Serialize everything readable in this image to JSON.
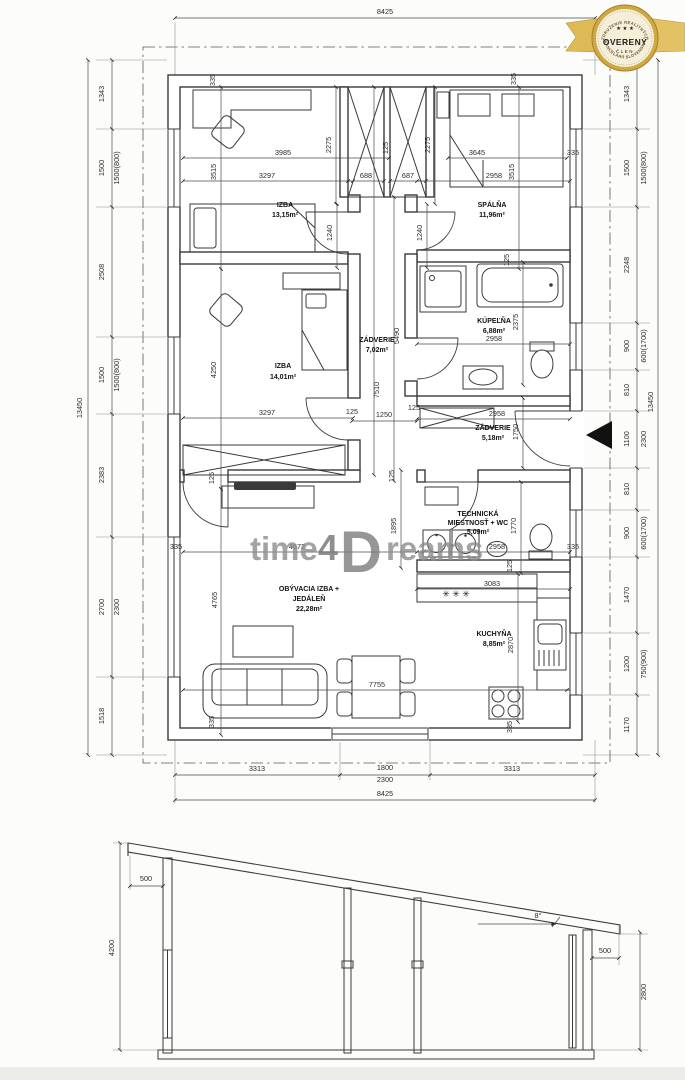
{
  "badge": {
    "arc_top": "ZDRUŽENIE REALITNÝCH",
    "arc_bottom": "KANCELÁRIÍ SLOVENSKA",
    "stars": "★ ★ ★",
    "title": "OVERENÝ",
    "subtitle": "ČLEN",
    "gold": "#cfa93f"
  },
  "watermark": {
    "t1": "time",
    "t2": "4",
    "t3": "D",
    "t4": "reams"
  },
  "rooms": {
    "izba1": {
      "name": "IZBA",
      "area": "13,15m²"
    },
    "spalna": {
      "name": "SPÁLŇA",
      "area": "11,96m²"
    },
    "zadverie1": {
      "name": "ZÁDVERIE",
      "area": "7,02m²"
    },
    "izba2": {
      "name": "IZBA",
      "area": "14,01m²"
    },
    "kupelna": {
      "name": "KÚPEĽŇA",
      "area": "6,88m²"
    },
    "zadverie2": {
      "name": "ZÁDVERIE",
      "area": "5,18m²"
    },
    "tech": {
      "l1": "TECHNICKÁ",
      "l2": "MIESTNOSŤ + WC",
      "area": "5,09m²"
    },
    "obyvacia": {
      "l1": "OBÝVACIA IZBA +",
      "l2": "JEDÁLEŇ",
      "area": "22,28m²"
    },
    "kuchyna": {
      "name": "KUCHYŇA",
      "area": "8,85m²"
    }
  },
  "fixtures": {
    "kitchen_stars": "✳ ✳ ✳"
  },
  "dims": {
    "d8425": "8425",
    "d13450": "13450",
    "d3313": "3313",
    "d1800": "1800",
    "d2300": "2300",
    "d1343": "1343",
    "d1500": "1500",
    "w1500_800": "1500(800)",
    "d2508": "2508",
    "d2383": "2383",
    "d2700": "2700",
    "d1518": "1518",
    "d2248": "2248",
    "d900": "900",
    "w600_1700": "600(1700)",
    "d810": "810",
    "d1100": "1100",
    "d1470": "1470",
    "d1200": "1200",
    "w750_900": "750(900)",
    "d1170": "1170",
    "d335": "335",
    "d125": "125",
    "d3985": "3985",
    "d2275": "2275",
    "d3645": "3645",
    "d3297": "3297",
    "d688": "688",
    "d687": "687",
    "d2958": "2958",
    "d3515": "3515",
    "d1240": "1240",
    "d4250": "4250",
    "d5490": "5490",
    "d7510": "7510",
    "d2375": "2375",
    "d1750": "1750",
    "d1250": "1250",
    "d1895": "1895",
    "d1770": "1770",
    "d4672": "4672",
    "d4765": "4765",
    "d3083": "3083",
    "d2870": "2870",
    "d7755": "7755"
  },
  "section": {
    "h_left": "4200",
    "h_right": "2800",
    "overhang": "500",
    "slope": "8°"
  }
}
